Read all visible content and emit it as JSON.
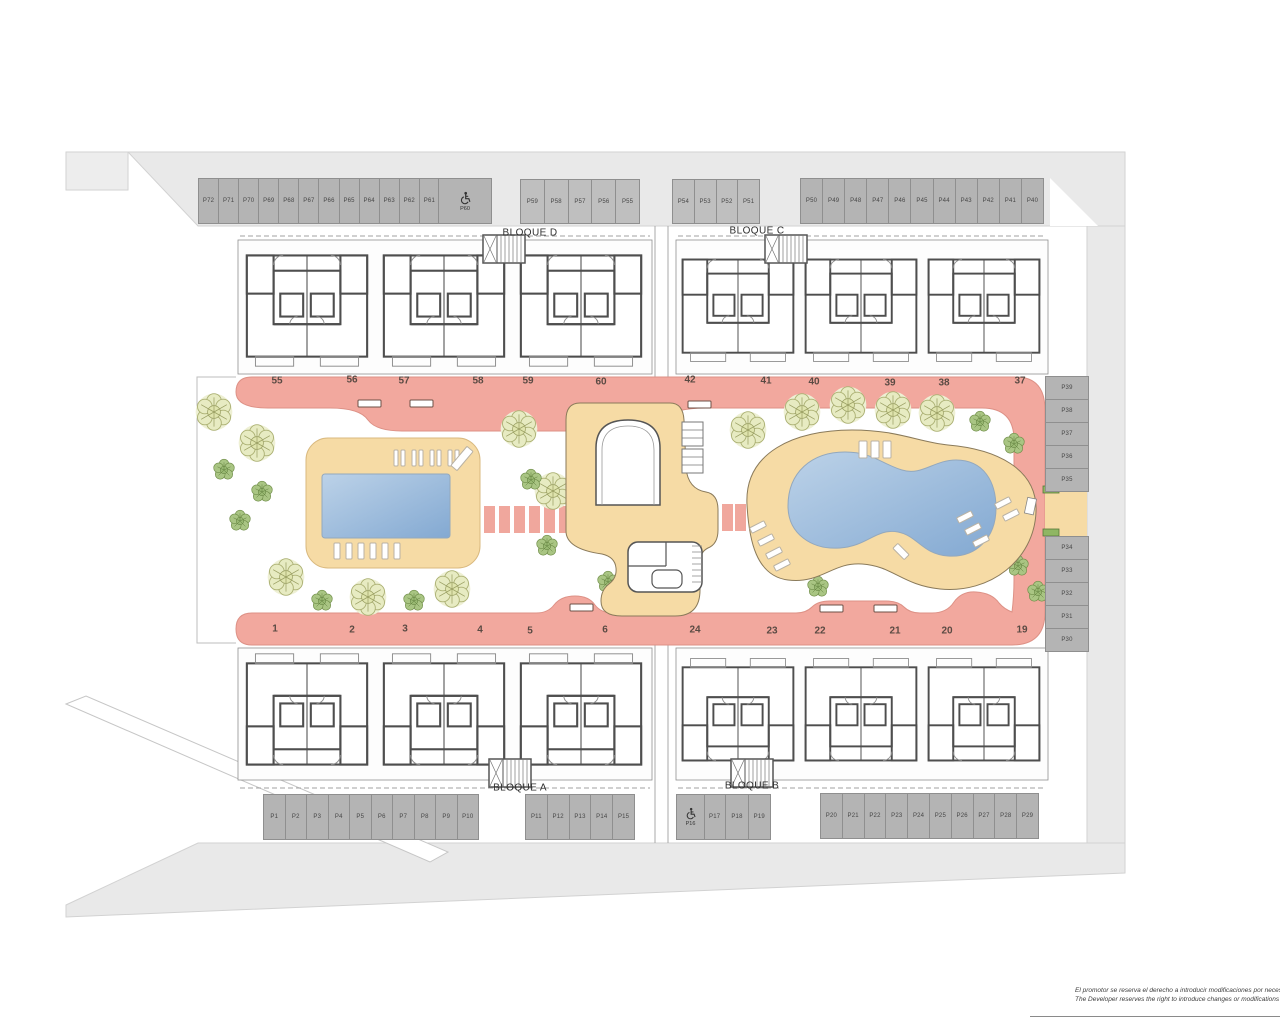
{
  "plan": {
    "blocks": {
      "d": "BLOQUE D",
      "c": "BLOQUE C",
      "a": "BLOQUE A",
      "b": "BLOQUE B"
    },
    "parking": {
      "top_left": [
        "P72",
        "P71",
        "P70",
        "P69",
        "P68",
        "P67",
        "P66",
        "P65",
        "P64",
        "P63",
        "P62",
        "P61"
      ],
      "top_left_accessible": "P60",
      "top_mid": [
        "P59",
        "P58",
        "P57",
        "P56",
        "P55"
      ],
      "top_center": [
        "P54",
        "P53",
        "P52",
        "P51"
      ],
      "top_right": [
        "P50",
        "P49",
        "P48",
        "P47",
        "P46",
        "P45",
        "P44",
        "P43",
        "P42",
        "P41",
        "P40"
      ],
      "right_upper": [
        "P39",
        "P38",
        "P37",
        "P36",
        "P35"
      ],
      "right_lower": [
        "P34",
        "P33",
        "P32",
        "P31",
        "P30"
      ],
      "bottom_left": [
        "P1",
        "P2",
        "P3",
        "P4",
        "P5",
        "P6",
        "P7",
        "P8",
        "P9",
        "P10"
      ],
      "bottom_mid": [
        "P11",
        "P12",
        "P13",
        "P14",
        "P15"
      ],
      "bottom_accessible": "P16",
      "bottom_center": [
        "P17",
        "P18",
        "P19"
      ],
      "bottom_right": [
        "P20",
        "P21",
        "P22",
        "P23",
        "P24",
        "P25",
        "P26",
        "P27",
        "P28",
        "P29"
      ]
    },
    "units": {
      "top_left_row": [
        "55",
        "56",
        "57",
        "58",
        "59",
        "60"
      ],
      "top_right_row": [
        "42",
        "41",
        "40",
        "39",
        "38",
        "37"
      ],
      "bottom_left_row": [
        "1",
        "2",
        "3",
        "4",
        "5",
        "6"
      ],
      "bottom_right_row": [
        "24",
        "23",
        "22",
        "21",
        "20",
        "19"
      ]
    },
    "icons": {
      "accessible": "wheelchair-icon",
      "tree_large": "tree-icon",
      "tree_small": "shrub-icon",
      "bench": "bench-icon",
      "sunbed": "sunbed-icon",
      "entrance_marker": "entrance-marker-icon"
    },
    "colors": {
      "path_pink": "#f2a89e",
      "deck_beige": "#f6dba5",
      "pool_blue": "#9dbcdc",
      "parking_gray": "#b4b4b4",
      "road_gray": "#e9e9e9",
      "tree_olive": "#e7ebc2",
      "tree_green": "#a9c583"
    },
    "disclaimer": {
      "line1": "El promotor se reserva el derecho a introducir modificaciones por necesi",
      "line2": "The Developer reserves the right to introduce changes or modifications t"
    }
  }
}
